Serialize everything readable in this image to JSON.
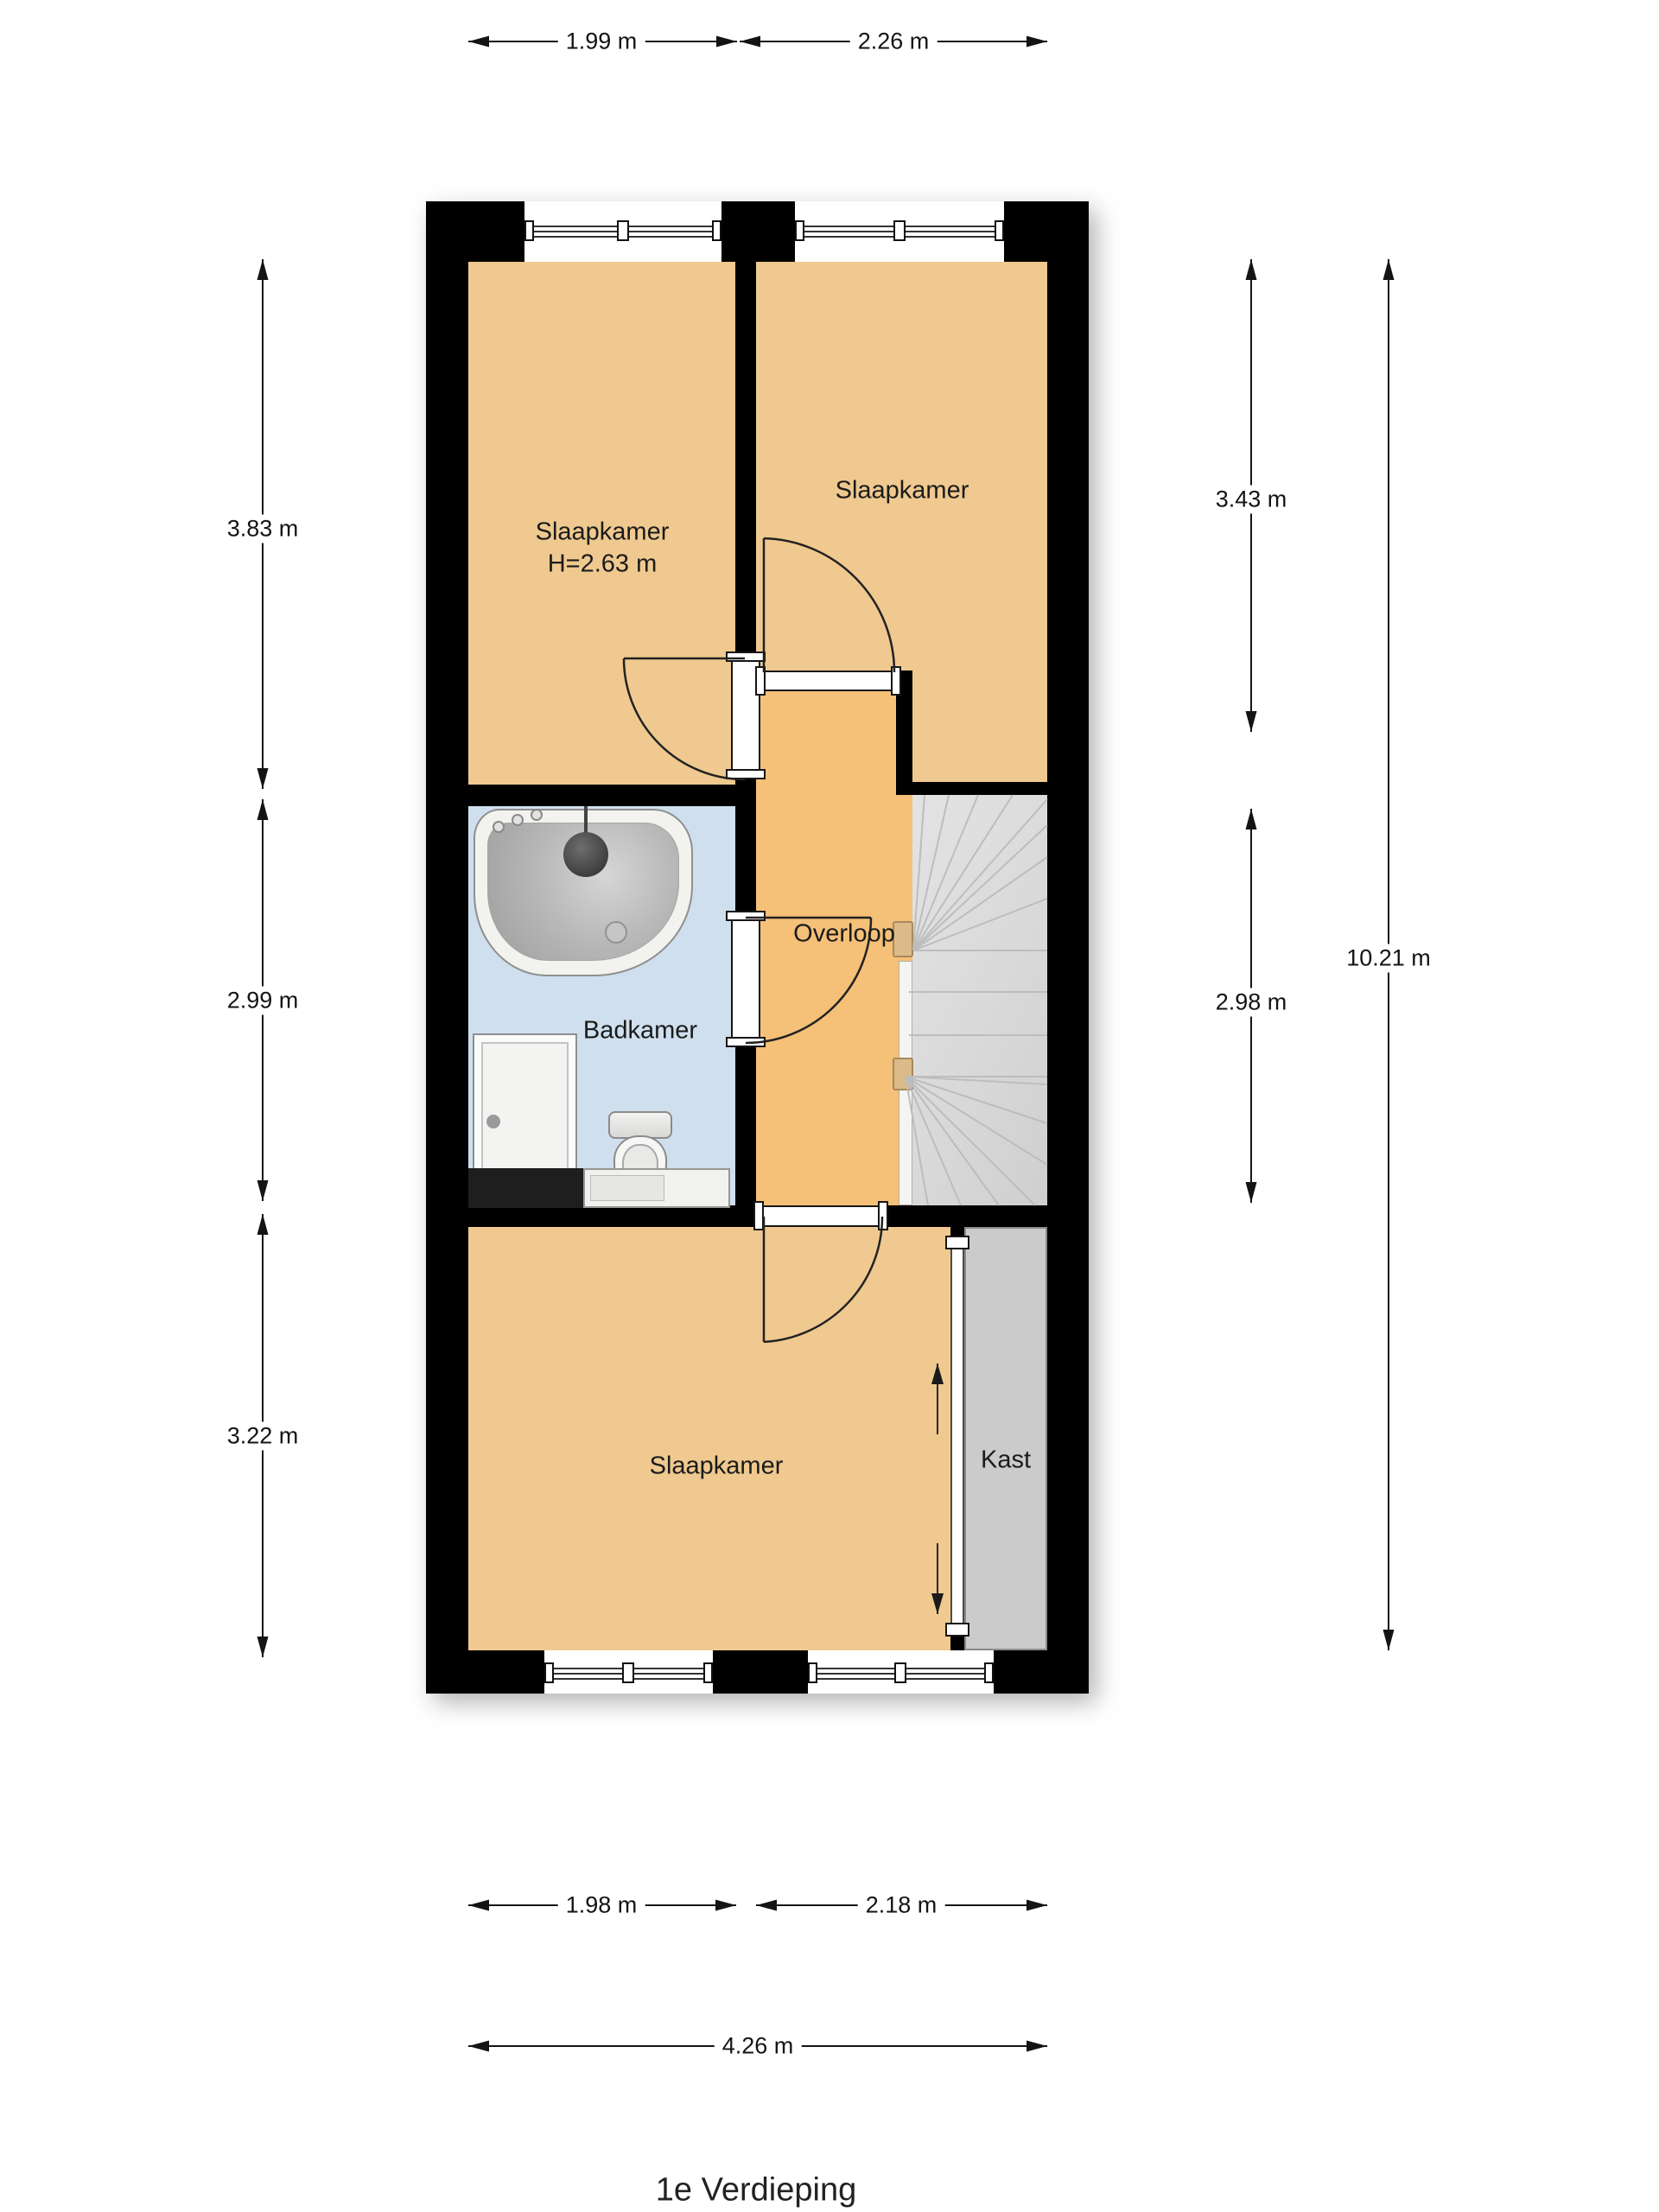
{
  "title": "1e Verdieping",
  "rooms": {
    "bedroom_top_left": {
      "label": "Slaapkamer",
      "height": "H=2.63 m"
    },
    "bedroom_top_right": {
      "label": "Slaapkamer"
    },
    "landing": {
      "label": "Overloop"
    },
    "bathroom": {
      "label": "Badkamer"
    },
    "bedroom_bottom": {
      "label": "Slaapkamer"
    },
    "closet": {
      "label": "Kast"
    }
  },
  "dimensions": {
    "top": [
      {
        "label": "1.99 m"
      },
      {
        "label": "2.26 m"
      }
    ],
    "bottom": [
      {
        "label": "1.98 m"
      },
      {
        "label": "2.18 m"
      }
    ],
    "bottom_total": {
      "label": "4.26 m"
    },
    "left": [
      {
        "label": "3.83 m"
      },
      {
        "label": "2.99 m"
      },
      {
        "label": "3.22 m"
      }
    ],
    "right": [
      {
        "label": "3.43 m"
      },
      {
        "label": "2.98 m"
      }
    ],
    "right_total": {
      "label": "10.21 m"
    }
  },
  "colors": {
    "wall": "#000000",
    "bedroom_floor": "#efc98f",
    "landing_floor": "#f5c077",
    "bathroom_floor": "#cfdfee",
    "stairs_floor": "#dcdcdc",
    "closet_floor": "#cbcbcb"
  }
}
